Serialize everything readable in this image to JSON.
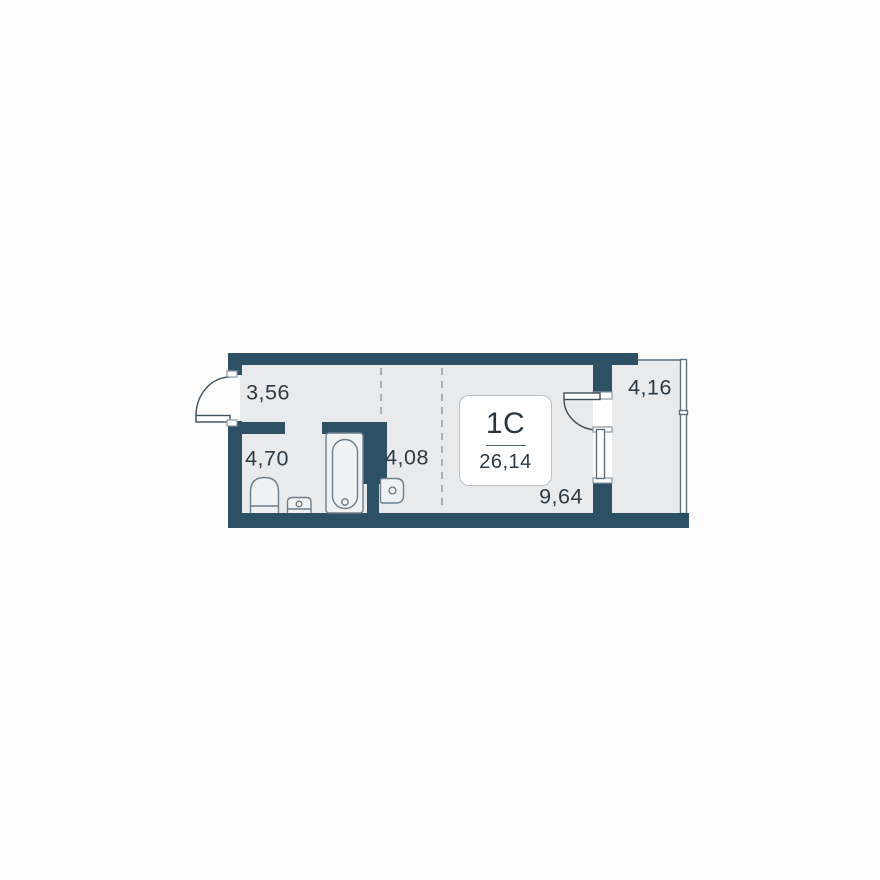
{
  "floorplan": {
    "unit": {
      "type_label": "1C",
      "total_area": "26,14"
    },
    "zones": {
      "hallway": {
        "area": "3,56"
      },
      "bathroom": {
        "area": "4,70"
      },
      "kitchen": {
        "area": "4,08"
      },
      "living": {
        "area": "9,64"
      },
      "balcony": {
        "area": "4,16"
      }
    },
    "colors": {
      "wall": "#2e5065",
      "floor": "#e9eaec",
      "background": "#fcfcfc",
      "text": "#2c3a46",
      "fixture_outline": "#6d7f8c"
    }
  }
}
